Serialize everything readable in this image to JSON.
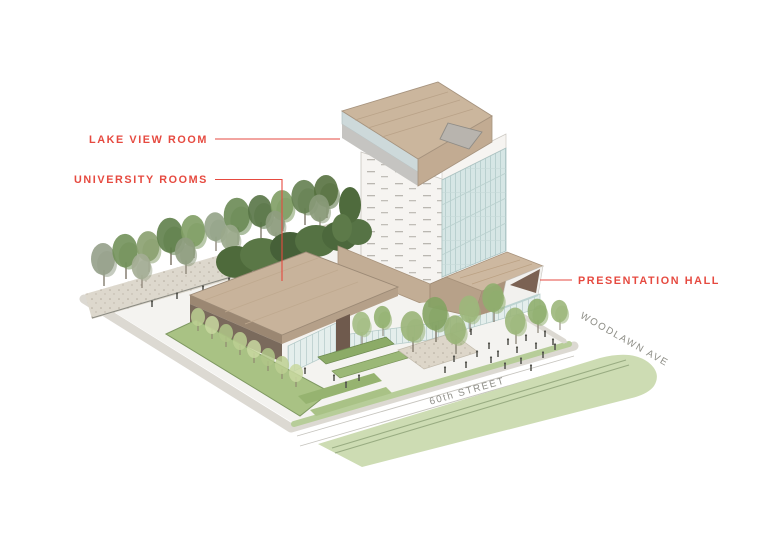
{
  "canvas": {
    "width": 780,
    "height": 546,
    "background": "#ffffff"
  },
  "callouts": {
    "lake_view_room": "LAKE VIEW ROOM",
    "university_rooms": "UNIVERSITY ROOMS",
    "presentation_hall": "PRESENTATION HALL"
  },
  "streets": {
    "street_60th": "60th STREET",
    "woodlawn_ave": "WOODLAWN AVE"
  },
  "colors": {
    "callout_red": "#e64a40",
    "street_gray": "#8e8e87",
    "wood_roof": "#cbb69d",
    "wood_face": "#c2ab92",
    "wood_dark": "#ab947c",
    "stone_white": "#f6f4f1",
    "glass_blue": "#d6e6e5",
    "glass_light": "#e7efee",
    "median_green": "#cddcb3",
    "verge_green": "#b7cd99",
    "garden_green": "#a9c284",
    "tree_dark_green": "#4e6a3b",
    "tree_green": "#72915a",
    "tree_gray_green": "#95a08a",
    "gravel": "#ddd8cd",
    "sidewalk": "#dcd9d2",
    "dark_wall_brown": "#6f5a4d"
  }
}
